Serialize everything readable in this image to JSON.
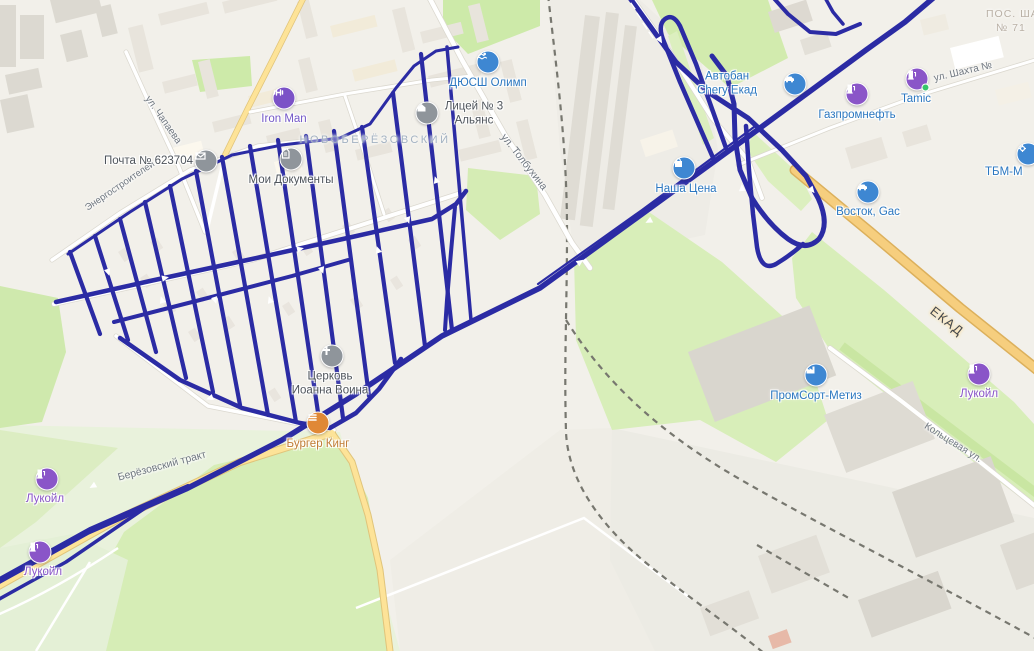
{
  "map": {
    "district": {
      "name": "НОВОБЕРЁЗОВСКИЙ"
    },
    "corner_district": {
      "line1": "ПОС. ША",
      "line2": "№ 71"
    },
    "road_labels": {
      "ekad": "ЕКАД",
      "berezovsky": "Берёзовский тракт",
      "koltsevaya": "Кольцевая ул.",
      "shakhta": "ул. Шахта №",
      "tolbukhina": "ул. Толбухина",
      "chapaeva": "ул. Чапаева",
      "energostroiteley": "Энергостроителей"
    },
    "pois": {
      "pochta": {
        "label": "Почта № 623704"
      },
      "moi_dokumenty": {
        "label": "Мои Документы"
      },
      "iron_man": {
        "label": "Iron Man"
      },
      "dyussh": {
        "label": "ДЮСШ Олимп"
      },
      "licey": {
        "line1": "Лицей № 3",
        "line2": "Альянс"
      },
      "tserkov": {
        "line1": "Церковь",
        "line2": "Иоанна Воина"
      },
      "burger_king": {
        "label": "Бургер Кинг"
      },
      "nasha_tsena": {
        "label": "Наша Цена"
      },
      "avtoban": {
        "line1": "Автобан",
        "line2": "Chery Екад"
      },
      "gazpromneft": {
        "label": "Газпромнефть"
      },
      "tamic": {
        "label": "Tamic"
      },
      "vostok": {
        "label": "Восток, Gac"
      },
      "tbm": {
        "label": "ТБМ-М"
      },
      "promsort": {
        "label": "ПромСорт-Метиз"
      },
      "lukoil_west_upper": {
        "label": "Лукойл"
      },
      "lukoil_west_lower": {
        "label": "Лукойл"
      },
      "lukoil_east": {
        "label": "Лукойл"
      }
    },
    "colors": {
      "gps_track": "#2b2ba4",
      "highway": "#f6ce7e",
      "poi_blue": "#3e87d2",
      "poi_purple": "#8a55c8",
      "poi_gray": "#8f959b",
      "poi_orange": "#e08836"
    }
  }
}
